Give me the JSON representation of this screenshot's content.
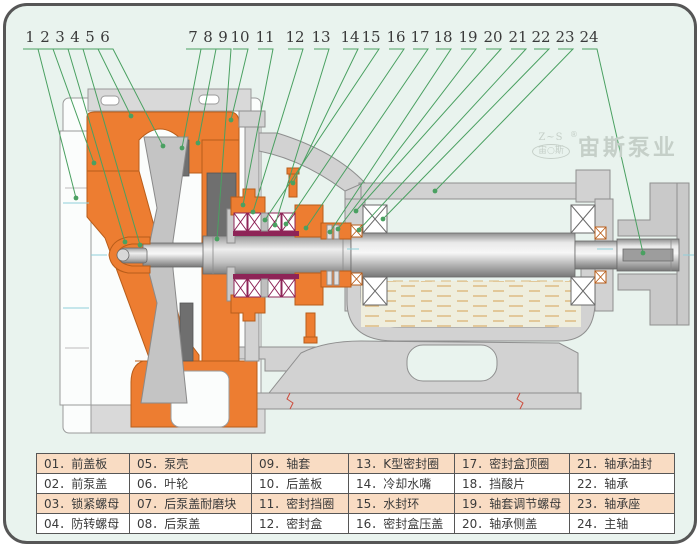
{
  "palette": {
    "bg": "#e9f3ee",
    "frame_border": "#565656",
    "orange": "#ed7d31",
    "orange_stroke": "#b85d1a",
    "maroon": "#8e2457",
    "leader_green": "#4aa061",
    "gray_light": "#d2d2d2",
    "gray_mid": "#c4c4c4",
    "gray_dark": "#6f6f6f",
    "outline": "#8f8f8f",
    "white_part": "#fbfdfc",
    "oil_dash": "#dcb87c",
    "oil_bg": "#efeedd",
    "table_shade": "#f9dcc3",
    "number_text": "#3a3a3a",
    "break_red": "#cc4b3c",
    "cyan_mark": "#8fd0da",
    "logo_gray": "#c5cfc8"
  },
  "logo": {
    "mark_top": "Z~S",
    "mark_reg": "®",
    "mark_oval": "宙○斯",
    "brand": "宙斯泵业"
  },
  "callouts": [
    {
      "n": "1",
      "lx": 27,
      "tx": 73,
      "ty": 195
    },
    {
      "n": "2",
      "lx": 42,
      "tx": 91,
      "ty": 160
    },
    {
      "n": "3",
      "lx": 57,
      "tx": 122,
      "ty": 239
    },
    {
      "n": "4",
      "lx": 72,
      "tx": 137,
      "ty": 242
    },
    {
      "n": "5",
      "lx": 87,
      "tx": 128,
      "ty": 113
    },
    {
      "n": "6",
      "lx": 102,
      "tx": 160,
      "ty": 143
    },
    {
      "n": "7",
      "lx": 190,
      "tx": 179,
      "ty": 145
    },
    {
      "n": "8",
      "lx": 205,
      "tx": 195,
      "ty": 140
    },
    {
      "n": "9",
      "lx": 220,
      "tx": 214,
      "ty": 236
    },
    {
      "n": "10",
      "lx": 237,
      "tx": 228,
      "ty": 117
    },
    {
      "n": "11",
      "lx": 262,
      "tx": 240,
      "ty": 202
    },
    {
      "n": "12",
      "lx": 292,
      "tx": 250,
      "ty": 209
    },
    {
      "n": "13",
      "lx": 318,
      "tx": 272,
      "ty": 222
    },
    {
      "n": "14",
      "lx": 347,
      "tx": 290,
      "ty": 180
    },
    {
      "n": "15",
      "lx": 368,
      "tx": 262,
      "ty": 217
    },
    {
      "n": "16",
      "lx": 393,
      "tx": 283,
      "ty": 221
    },
    {
      "n": "17",
      "lx": 417,
      "tx": 303,
      "ty": 225
    },
    {
      "n": "18",
      "lx": 440,
      "tx": 327,
      "ty": 229
    },
    {
      "n": "19",
      "lx": 465,
      "tx": 335,
      "ty": 226
    },
    {
      "n": "20",
      "lx": 490,
      "tx": 353,
      "ty": 208
    },
    {
      "n": "21",
      "lx": 515,
      "tx": 356,
      "ty": 227
    },
    {
      "n": "22",
      "lx": 538,
      "tx": 380,
      "ty": 216
    },
    {
      "n": "23",
      "lx": 562,
      "tx": 432,
      "ty": 188
    },
    {
      "n": "24",
      "lx": 586,
      "tx": 640,
      "ty": 250
    }
  ],
  "table": {
    "separator": "．",
    "items": [
      {
        "id": "01",
        "name": "前盖板"
      },
      {
        "id": "02",
        "name": "前泵盖"
      },
      {
        "id": "03",
        "name": "锁紧螺母"
      },
      {
        "id": "04",
        "name": "防转螺母"
      },
      {
        "id": "05",
        "name": "泵壳"
      },
      {
        "id": "06",
        "name": "叶轮"
      },
      {
        "id": "07",
        "name": "后泵盖耐磨块"
      },
      {
        "id": "08",
        "name": "后泵盖"
      },
      {
        "id": "09",
        "name": "轴套"
      },
      {
        "id": "10",
        "name": "后盖板"
      },
      {
        "id": "11",
        "name": "密封挡圈"
      },
      {
        "id": "12",
        "name": "密封盒"
      },
      {
        "id": "13",
        "name": "K型密封圈"
      },
      {
        "id": "14",
        "name": "冷却水嘴"
      },
      {
        "id": "15",
        "name": "水封环"
      },
      {
        "id": "16",
        "name": "密封盒压盖"
      },
      {
        "id": "17",
        "name": "密封盒顶圈"
      },
      {
        "id": "18",
        "name": "挡酸片"
      },
      {
        "id": "19",
        "name": "轴套调节螺母"
      },
      {
        "id": "20",
        "name": "轴承侧盖"
      },
      {
        "id": "21",
        "name": "轴承油封"
      },
      {
        "id": "22",
        "name": "轴承座"
      },
      {
        "id": "23",
        "name": "轴承座"
      },
      {
        "id": "24",
        "name": "主轴"
      }
    ],
    "items_fix": [
      {
        "id": "22",
        "name": "轴承"
      }
    ],
    "col_widths": [
      93,
      122,
      97,
      106,
      115,
      105
    ]
  }
}
